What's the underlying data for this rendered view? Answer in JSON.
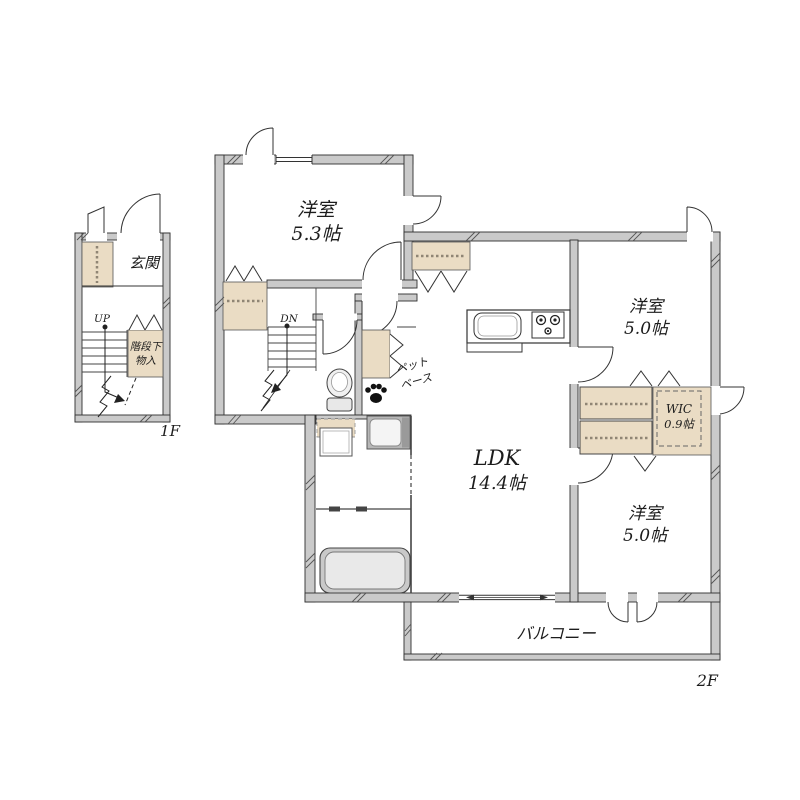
{
  "plan": {
    "floor1": {
      "floor_label": "1F",
      "entrance_label": "玄関",
      "stairs_label": "UP",
      "under_stairs_storage": [
        "階段下",
        "物入"
      ]
    },
    "floor2": {
      "floor_label": "2F",
      "stairs_label": "DN",
      "bedroom_nw": {
        "name": "洋室",
        "size": "5.3帖"
      },
      "bedroom_ne": {
        "name": "洋室",
        "size": "5.0帖"
      },
      "bedroom_se": {
        "name": "洋室",
        "size": "5.0帖"
      },
      "ldk": {
        "name": "LDK",
        "size": "14.4帖"
      },
      "wic": {
        "name": "WIC",
        "size": "0.9帖"
      },
      "pet_space": [
        "ペット",
        "ベース"
      ],
      "balcony_label": "バルコニー"
    },
    "colors": {
      "wall_fill": "#cacaca",
      "storage_fill": "#eadcc4",
      "outline": "#333333",
      "background": "#ffffff"
    }
  }
}
